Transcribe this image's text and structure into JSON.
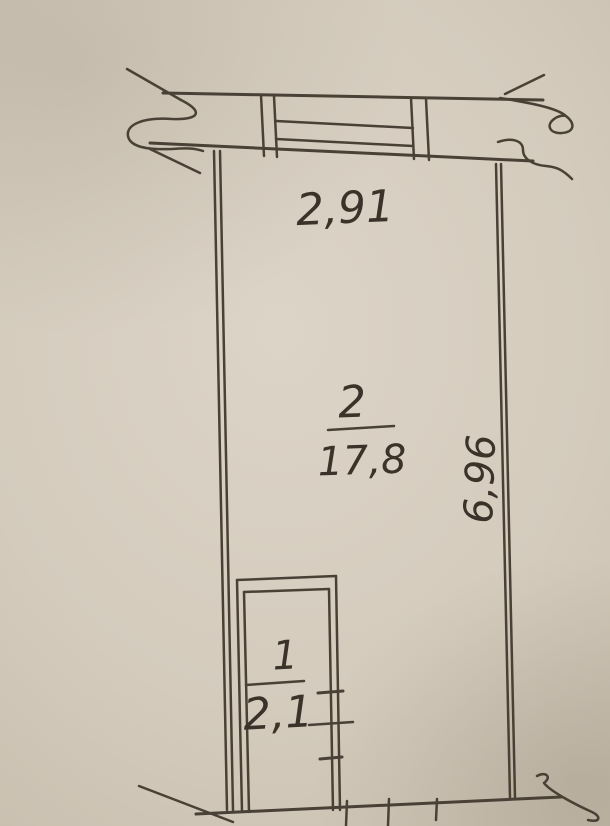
{
  "meta": {
    "description": "Photograph of a hand-drafted BTI floor plan on beige paper",
    "units": "meters / square meters"
  },
  "plan": {
    "rooms": [
      {
        "id": "room-2",
        "number": "2",
        "area": "17,8"
      },
      {
        "id": "room-1",
        "number": "1",
        "area": "2,1"
      }
    ],
    "dimensions": {
      "top_width": "2,91",
      "right_height": "6,96"
    },
    "features": [
      "window-symbol-top-wall",
      "break-marks-at-wall-cuts",
      "door-ticks-room-1-right-wall"
    ]
  },
  "colors": {
    "paper": "#d6cdc0",
    "ink": "#4a4136",
    "text": "#3b332a"
  }
}
